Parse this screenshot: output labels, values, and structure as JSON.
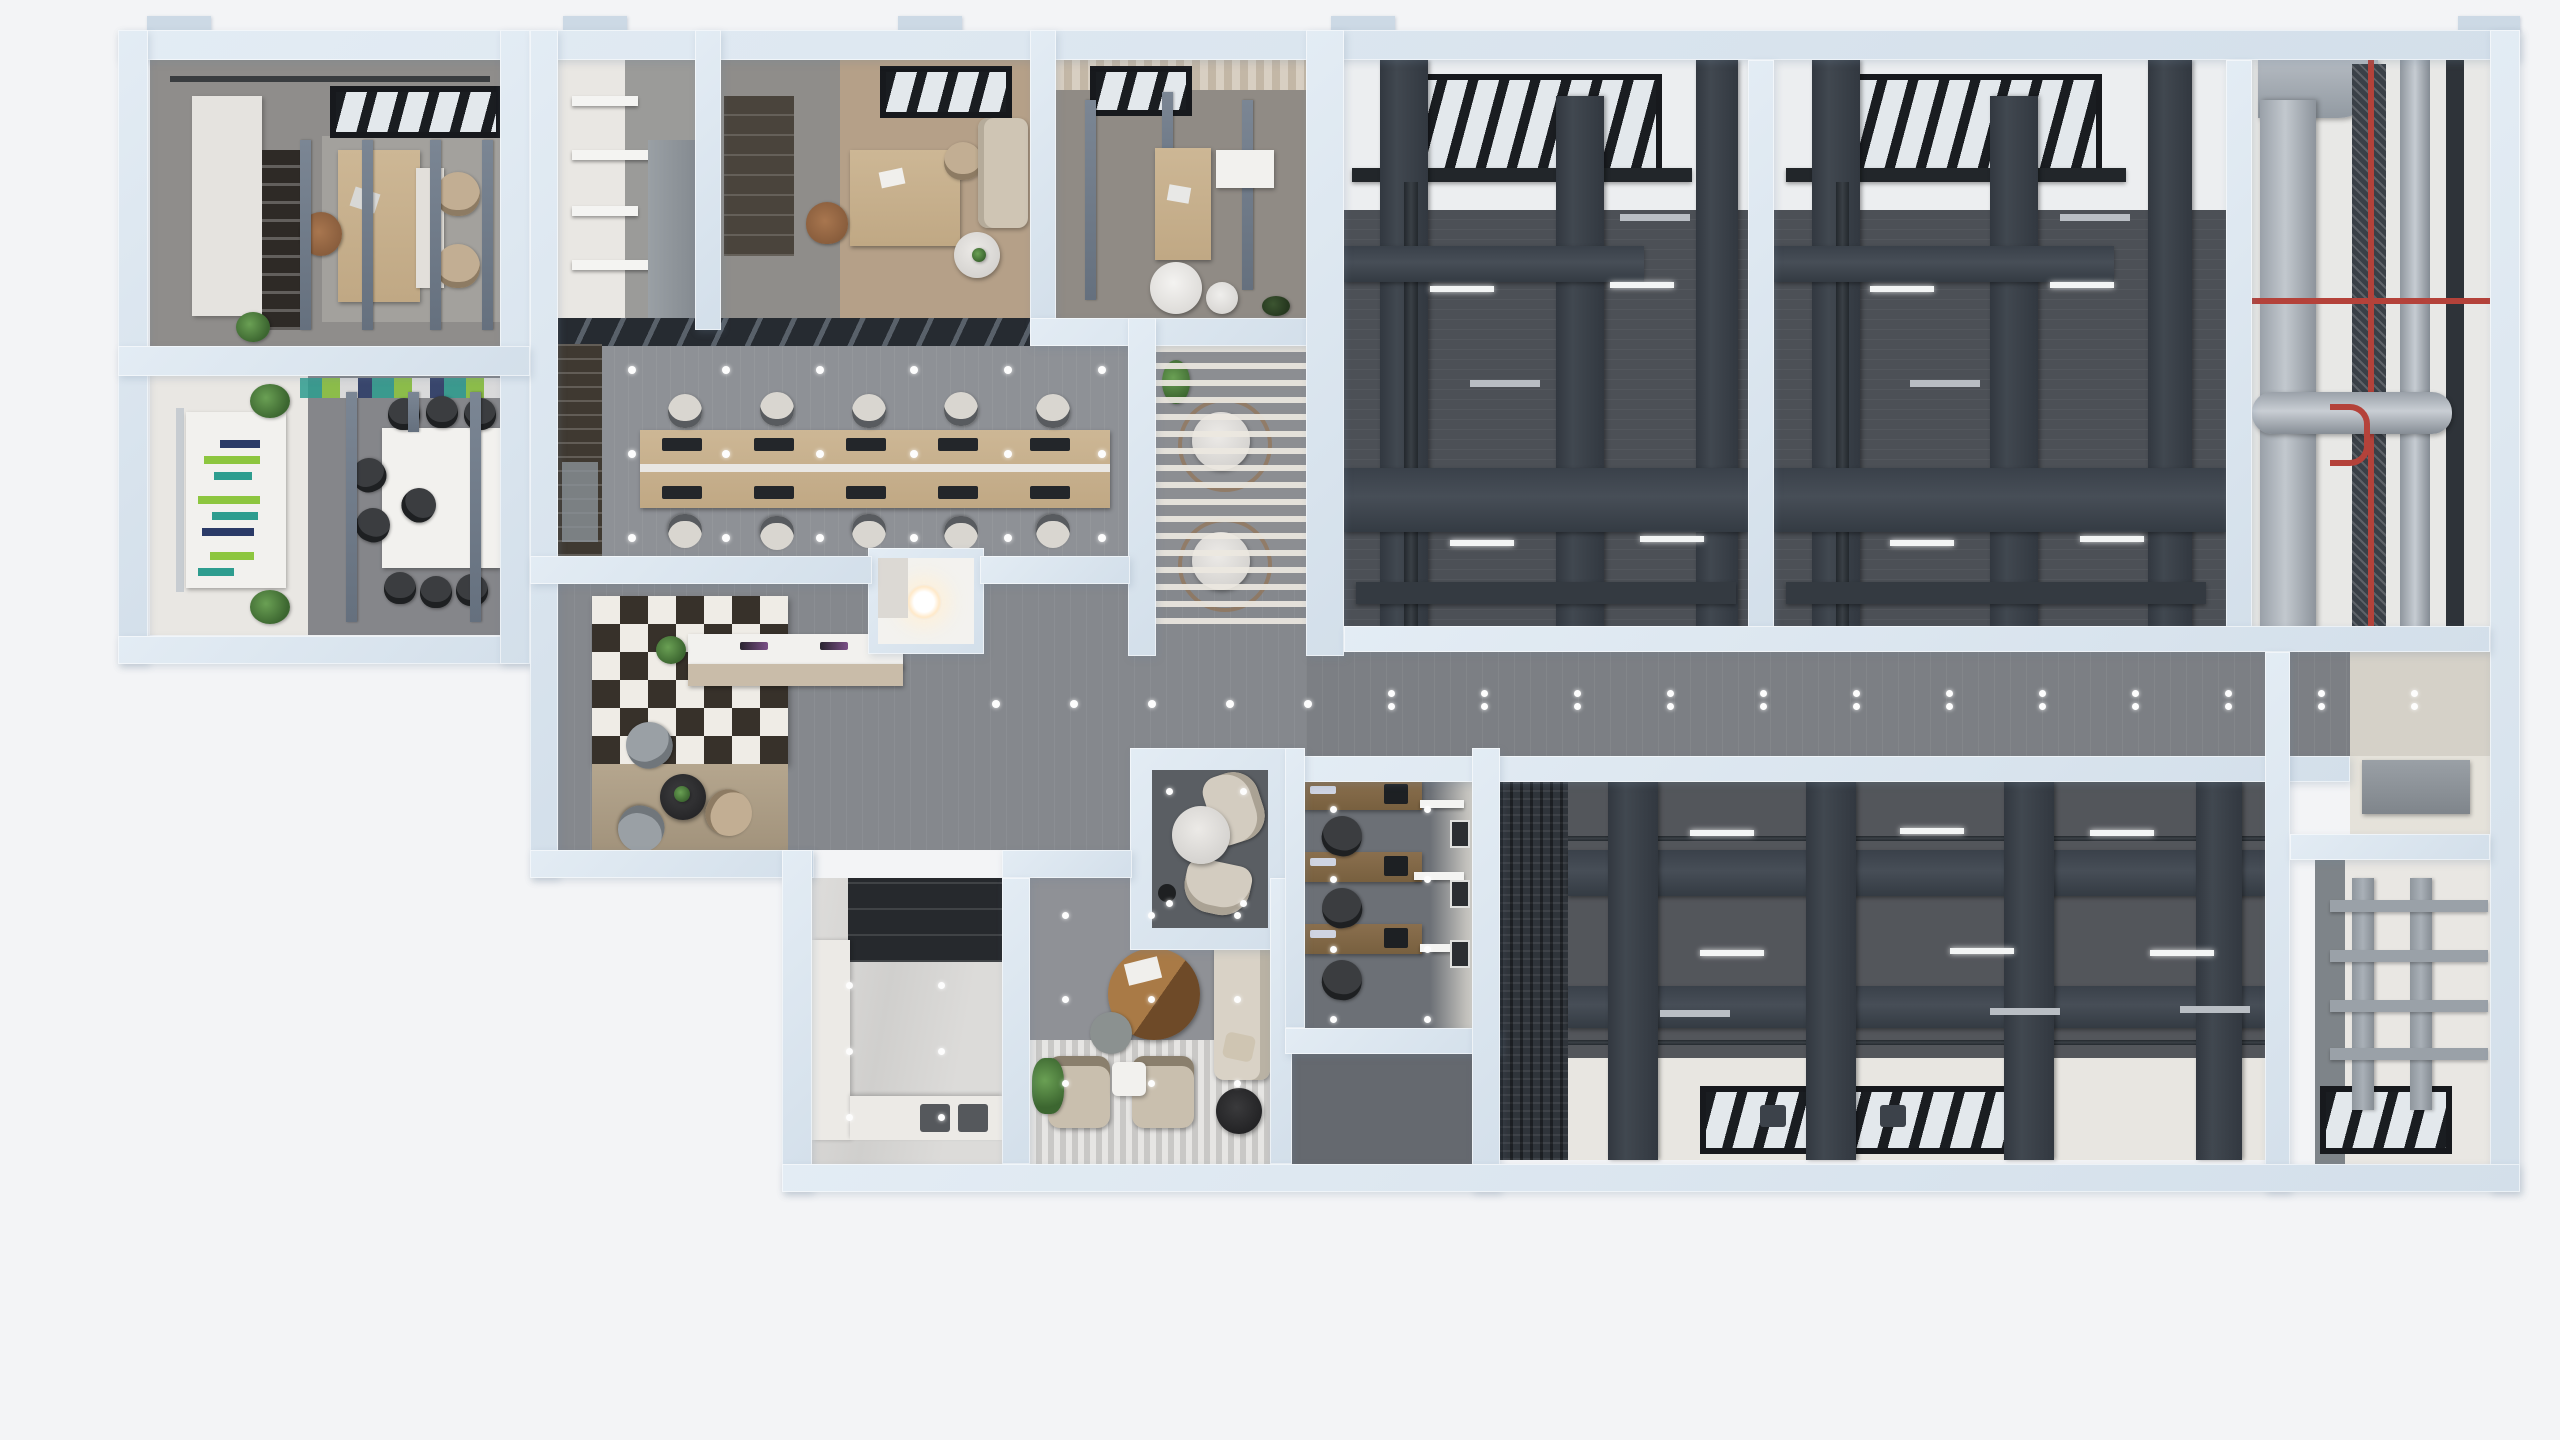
{
  "scene": {
    "kind": "3D architectural floor plan rendering",
    "view": "top-down cutaway (dollhouse) of an office floor with unfinished mechanical zones",
    "background": "#f3f4f6"
  },
  "palette": {
    "wall": "#d9e4ef",
    "wall_fin": "#ccd9e5",
    "floor_gray": "#8e9196",
    "floor_dark": "#4c5056",
    "floor_light": "#e9e7e3",
    "floor_beige": "#d5d1c8",
    "duct_dark": "#3b414a",
    "duct_silver": "#a7aeb6",
    "sprinkler_pipe_red": "#b4423a",
    "wood": "#c8b393",
    "accent_teal": "#3fc4c9",
    "plant_green": "#4d7c3f",
    "marble": "#e0dfdc",
    "screen_bar_green": "#8dc63f",
    "screen_bar_teal": "#2e9d8f",
    "screen_bar_navy": "#2b3a67"
  },
  "rooms": {
    "executive_office": {
      "name": "Executive office with desk, two guest chairs and bookshelf"
    },
    "conference_room": {
      "name": "Conference room with long white table and presentation screen"
    },
    "storage_room": {
      "name": "Copy / storage room with wall shelves"
    },
    "manager_office_1": {
      "name": "Manager office with desk, sofa and round table"
    },
    "manager_office_2": {
      "name": "Manager office with desk, side cabinet and coffee tables"
    },
    "open_office": {
      "name": "Open-plan office with shared bench desk"
    },
    "louver_lounge": {
      "name": "Louvered breakout lounge with two marble tables"
    },
    "lobby": {
      "name": "Reception lobby with feature shelf wall and reception desk"
    },
    "nook": {
      "name": "Small utility room with round ceiling light"
    },
    "corridor": {
      "name": "Main corridor with paired downlights"
    },
    "kitchen": {
      "name": "Kitchen with dark upper units and L-shaped white counter"
    },
    "staff_lounge": {
      "name": "Staff lounge with armchairs, sofa and round coffee table"
    },
    "meeting_pod": {
      "name": "Meeting pod with marble table and curved sofas"
    },
    "workstation_office": {
      "name": "Office with three desks and wall shelves"
    },
    "mech_bay_1": {
      "name": "Unfinished mechanical bay 1 with HVAC duct grid"
    },
    "mech_bay_2": {
      "name": "Unfinished mechanical bay 2 with HVAC duct grid"
    },
    "riser_shaft": {
      "name": "Mechanical riser shaft with silver ducts and red sprinkler pipes"
    },
    "mech_hall": {
      "name": "Large unfinished mechanical hall with duct grid and skylights"
    },
    "rack_room": {
      "name": "Storage room with metal shelving racks"
    },
    "service_niche": {
      "name": "Service niche with wall cabinet"
    }
  },
  "counts": {
    "open_office_workstations": 10,
    "open_office_chairs": 10,
    "conference_chairs": 9,
    "mechanical_bays_top": 3,
    "marble_lounge_tables": 2,
    "staff_lounge_armchairs": 2,
    "workstation_office_desks": 3,
    "reception_screens": 2,
    "skylights_bottom": 2
  }
}
